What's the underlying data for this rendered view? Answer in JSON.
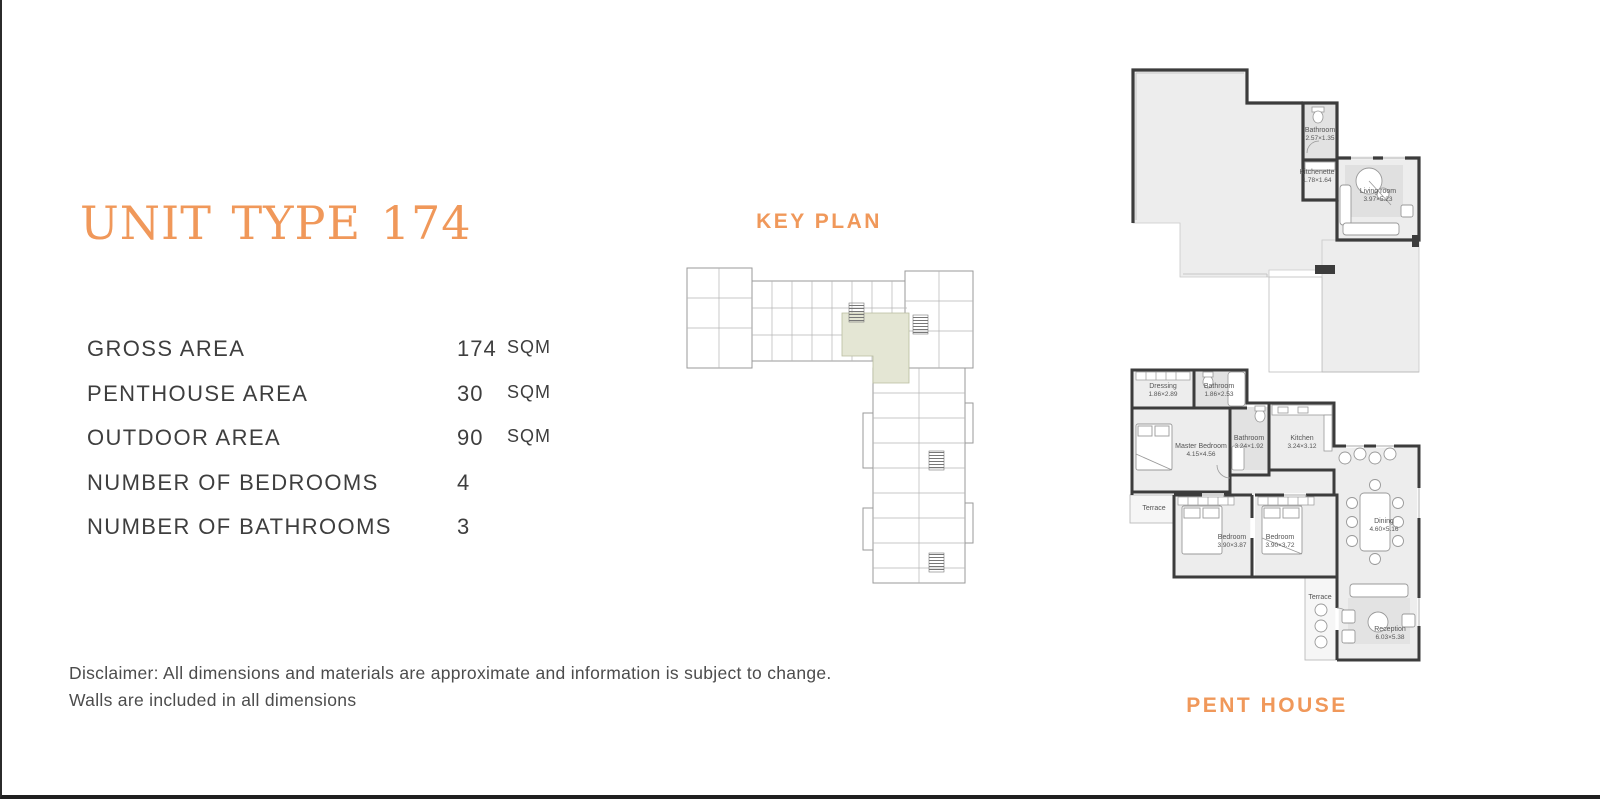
{
  "colors": {
    "accent": "#F0985A",
    "text": "#3E3E3E",
    "muted": "#4C4C4C",
    "wall": "#3C3C3C",
    "floor": "#EDEDED",
    "highlight": "#E4E6D4"
  },
  "header": {
    "title": "UNIT TYPE 174"
  },
  "specs": [
    {
      "label": "GROSS AREA",
      "value": "174",
      "unit": "SQM"
    },
    {
      "label": "PENTHOUSE AREA",
      "value": "30",
      "unit": "SQM"
    },
    {
      "label": "OUTDOOR AREA",
      "value": "90",
      "unit": "SQM"
    },
    {
      "label": "NUMBER OF BEDROOMS",
      "value": "4",
      "unit": ""
    },
    {
      "label": "NUMBER OF BATHROOMS",
      "value": "3",
      "unit": ""
    }
  ],
  "disclaimer": {
    "line1": "Disclaimer: All dimensions and materials are approximate and information is subject to change.",
    "line2": "Walls are included in all dimensions"
  },
  "key_plan": {
    "title": "KEY PLAN"
  },
  "plans": {
    "caption": "PENT HOUSE",
    "upper_rooms": [
      {
        "name": "Bathroom",
        "dims": "2.57×1.35"
      },
      {
        "name": "Kitchenette",
        "dims": "1.78×1.64"
      },
      {
        "name": "Living room",
        "dims": "3.97×5.23"
      }
    ],
    "lower_rooms": [
      {
        "name": "Dressing",
        "dims": "1.86×2.89"
      },
      {
        "name": "Bathroom",
        "dims": "1.86×2.53"
      },
      {
        "name": "Master Bedroom",
        "dims": "4.15×4.56"
      },
      {
        "name": "Bathroom",
        "dims": "3.24×1.92"
      },
      {
        "name": "Kitchen",
        "dims": "3.24×3.12"
      },
      {
        "name": "Terrace",
        "dims": ""
      },
      {
        "name": "Bedroom",
        "dims": "3.90×3.87"
      },
      {
        "name": "Bedroom",
        "dims": "3.90×3.72"
      },
      {
        "name": "Dining",
        "dims": "4.60×5.16"
      },
      {
        "name": "Terrace",
        "dims": ""
      },
      {
        "name": "Reception",
        "dims": "6.03×5.38"
      }
    ]
  }
}
